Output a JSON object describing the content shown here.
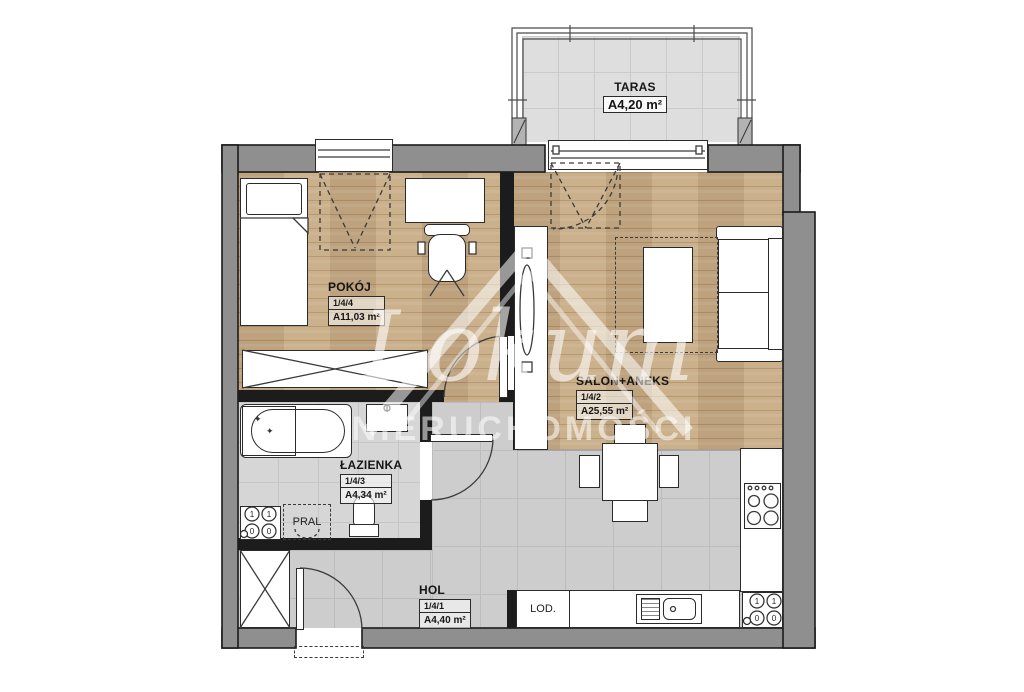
{
  "plan": {
    "brand": {
      "name": "Lokum",
      "subtitle": "NIERUCHOMOŚCI"
    },
    "rooms": [
      {
        "key": "taras",
        "name": "TARAS",
        "unit": "",
        "area": "A4,20 m²"
      },
      {
        "key": "pokoj",
        "name": "POKÓJ",
        "unit": "1/4/4",
        "area": "A11,03 m²"
      },
      {
        "key": "salon",
        "name": "SALON+ANEKS",
        "unit": "1/4/2",
        "area": "A25,55 m²"
      },
      {
        "key": "lazienka",
        "name": "ŁAZIENKA",
        "unit": "1/4/3",
        "area": "A4,34 m²"
      },
      {
        "key": "hol",
        "name": "HOL",
        "unit": "1/4/1",
        "area": "A4,40 m²"
      }
    ],
    "fixtures": {
      "washer": "PRAL",
      "fridge": "LOD.",
      "dial_on": "1",
      "dial_off": "0"
    },
    "colors": {
      "wall": "#8f8f8f",
      "outline": "#1b1b1b",
      "wood": "#c7ab84",
      "tile": "#cdcdcd",
      "bath_tile": "#d6d6d6",
      "terrace_tile": "#dedede"
    }
  }
}
